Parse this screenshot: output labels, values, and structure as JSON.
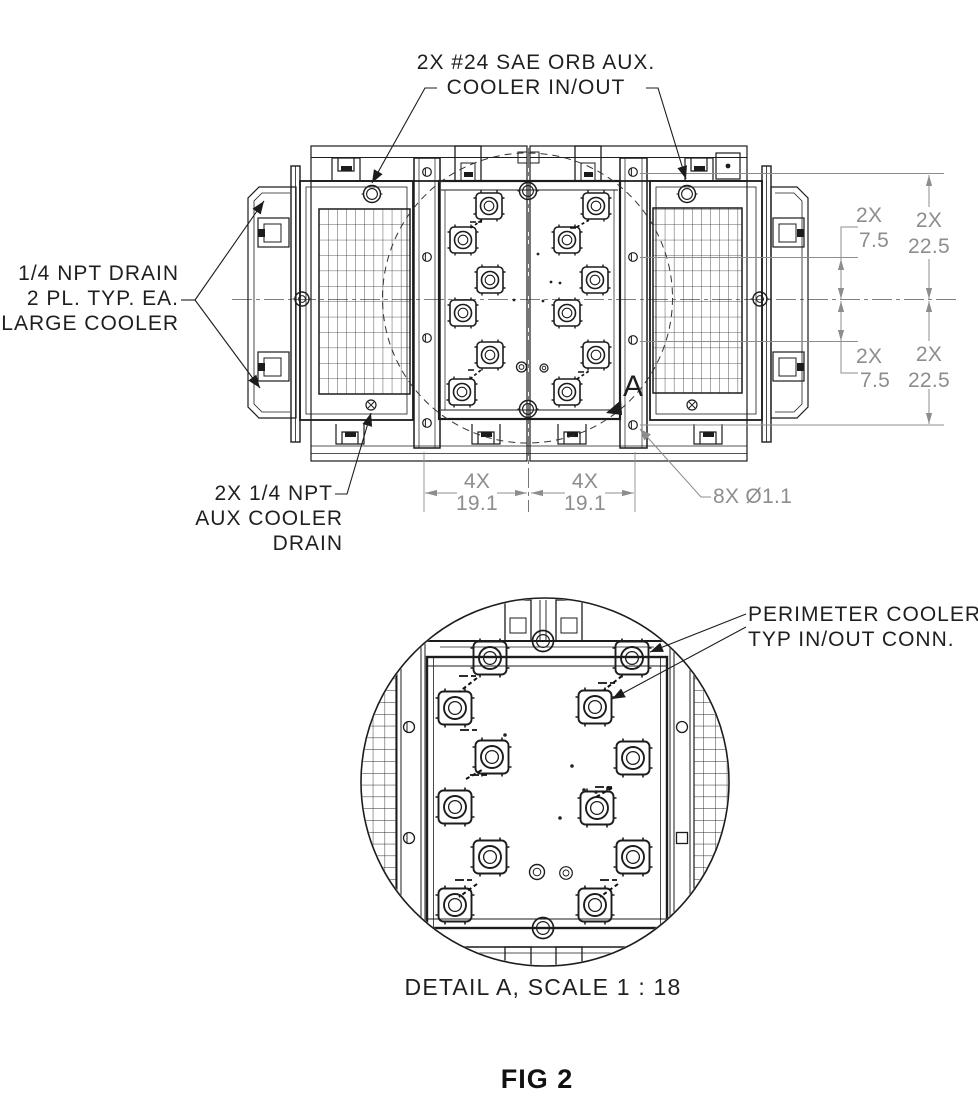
{
  "figure": {
    "caption": "FIG 2",
    "detail_caption": "DETAIL A, SCALE 1 : 18",
    "detail_marker": "A"
  },
  "callouts": {
    "aux_inout_line1": "2X #24 SAE ORB AUX.",
    "aux_inout_line2": "COOLER IN/OUT",
    "npt_drain_line1": "1/4 NPT DRAIN",
    "npt_drain_line2": "2 PL. TYP. EA.",
    "npt_drain_line3": "LARGE COOLER",
    "aux_drain_line1": "2X 1/4 NPT",
    "aux_drain_line2": "AUX COOLER",
    "aux_drain_line3": "DRAIN",
    "perimeter_line1": "PERIMETER COOLER",
    "perimeter_line2": "TYP IN/OUT CONN."
  },
  "dimensions": {
    "right_top_small_qty": "2X",
    "right_top_small_value": "7.5",
    "right_top_large_qty": "2X",
    "right_top_large_value": "22.5",
    "right_bottom_small_qty": "2X",
    "right_bottom_small_value": "7.5",
    "right_bottom_large_qty": "2X",
    "right_bottom_large_value": "22.5",
    "bottom_left_qty": "4X",
    "bottom_left_value": "19.1",
    "bottom_right_qty": "4X",
    "bottom_right_value": "19.1",
    "bolt_holes": "8X Ø1.1"
  }
}
